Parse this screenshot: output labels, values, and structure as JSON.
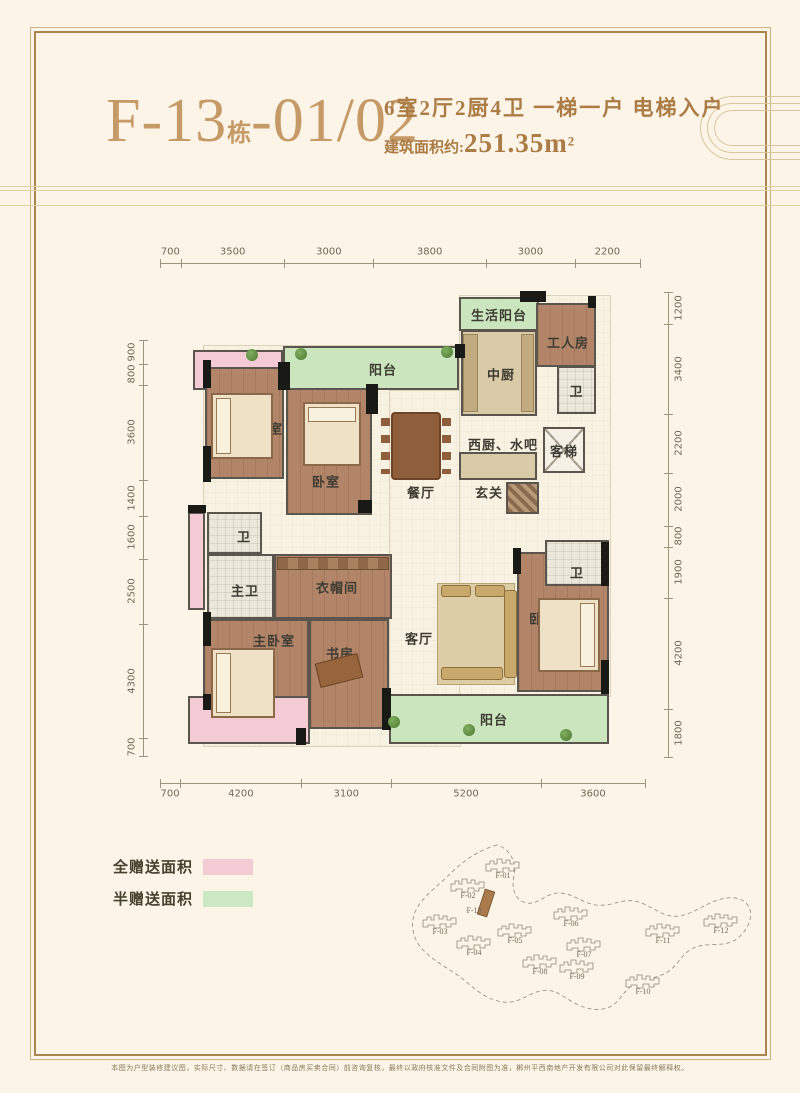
{
  "header": {
    "unit_code_main": "F-13",
    "unit_code_suffix": "栋",
    "unit_code_number": "-01/02",
    "spec_line": "6室2厅2厨4卫 一梯一户 电梯入户",
    "area_label": "建筑面积约:",
    "area_value": "251.35m",
    "area_sup": "2"
  },
  "floorplan": {
    "dimensions": {
      "top": [
        700,
        3500,
        3000,
        3800,
        3000,
        2200
      ],
      "bottom": [
        700,
        4200,
        3100,
        5200,
        3600
      ],
      "left": [
        900,
        800,
        3600,
        1400,
        1600,
        2500,
        4300,
        700
      ],
      "right": [
        1200,
        3400,
        2200,
        2000,
        800,
        1900,
        4200,
        1800
      ]
    },
    "bases": [
      {
        "x": 203,
        "y": 345,
        "w": 256,
        "h": 400
      },
      {
        "x": 389,
        "y": 390,
        "w": 220,
        "h": 305
      },
      {
        "x": 459,
        "y": 295,
        "w": 150,
        "h": 400
      }
    ],
    "rooms": [
      {
        "id": "gift-balcony-top",
        "label": "",
        "x": 193,
        "y": 350,
        "w": 90,
        "h": 40,
        "fill": "pink"
      },
      {
        "id": "balcony-top",
        "label": "阳台",
        "x": 283,
        "y": 346,
        "w": 176,
        "h": 44,
        "fill": "green",
        "lx": 381,
        "ly": 367
      },
      {
        "id": "life-balcony",
        "label": "生活阳台",
        "x": 459,
        "y": 297,
        "w": 80,
        "h": 34,
        "fill": "green"
      },
      {
        "id": "worker-room",
        "label": "工人房",
        "x": 536,
        "y": 303,
        "w": 60,
        "h": 64,
        "fill": "wood",
        "lx": 566,
        "ly": 340
      },
      {
        "id": "kitchen-cn",
        "label": "中厨",
        "x": 461,
        "y": 330,
        "w": 76,
        "h": 86,
        "fill": "counter",
        "lx": 499,
        "ly": 372
      },
      {
        "id": "bath-top",
        "label": "卫",
        "x": 557,
        "y": 366,
        "w": 39,
        "h": 48,
        "fill": "tile"
      },
      {
        "id": "elevator",
        "label": "客梯",
        "x": 543,
        "y": 427,
        "w": 42,
        "h": 46,
        "fill": "elevator"
      },
      {
        "id": "west-kitchen-bar",
        "label": "",
        "x": 459,
        "y": 452,
        "w": 78,
        "h": 28,
        "fill": "counter"
      },
      {
        "id": "foyer-rug",
        "label": "",
        "x": 506,
        "y": 482,
        "w": 33,
        "h": 32,
        "fill": "rug"
      },
      {
        "id": "bedroom-1",
        "label": "卧室",
        "x": 205,
        "y": 367,
        "w": 79,
        "h": 112,
        "fill": "wood",
        "lx": 267,
        "ly": 426
      },
      {
        "id": "bedroom-2",
        "label": "卧室",
        "x": 286,
        "y": 388,
        "w": 86,
        "h": 127,
        "fill": "wood",
        "lx": 324,
        "ly": 479
      },
      {
        "id": "bath-2",
        "label": "卫",
        "x": 207,
        "y": 512,
        "w": 55,
        "h": 42,
        "fill": "tile",
        "lx": 242,
        "ly": 534
      },
      {
        "id": "master-bath",
        "label": "主卫",
        "x": 207,
        "y": 554,
        "w": 67,
        "h": 65,
        "fill": "tile",
        "lx": 243,
        "ly": 588
      },
      {
        "id": "closet",
        "label": "衣帽间",
        "x": 274,
        "y": 554,
        "w": 118,
        "h": 65,
        "fill": "wood",
        "lx": 335,
        "ly": 585
      },
      {
        "id": "master-bedroom",
        "label": "主卧室",
        "x": 203,
        "y": 619,
        "w": 106,
        "h": 110,
        "fill": "wood",
        "lx": 272,
        "ly": 638
      },
      {
        "id": "study",
        "label": "书房",
        "x": 309,
        "y": 619,
        "w": 80,
        "h": 110,
        "fill": "wood",
        "lx": 338,
        "ly": 651
      },
      {
        "id": "bedroom-3",
        "label": "卧室",
        "x": 517,
        "y": 552,
        "w": 92,
        "h": 140,
        "fill": "wood",
        "lx": 541,
        "ly": 616
      },
      {
        "id": "bath-3",
        "label": "卫",
        "x": 545,
        "y": 540,
        "w": 64,
        "h": 46,
        "fill": "tile",
        "lx": 575,
        "ly": 570
      },
      {
        "id": "balcony-bottom",
        "label": "阳台",
        "x": 389,
        "y": 694,
        "w": 220,
        "h": 50,
        "fill": "green",
        "lx": 492,
        "ly": 717
      },
      {
        "id": "gift-strip-left",
        "label": "",
        "x": 188,
        "y": 512,
        "w": 17,
        "h": 98,
        "fill": "pink"
      },
      {
        "id": "gift-balcony-bottom",
        "label": "",
        "x": 188,
        "y": 696,
        "w": 122,
        "h": 48,
        "fill": "pink"
      }
    ],
    "texts": [
      {
        "text": "西厨、水吧",
        "x": 503,
        "y": 444
      },
      {
        "text": "玄关",
        "x": 489,
        "y": 492
      },
      {
        "text": "餐厅",
        "x": 421,
        "y": 492
      },
      {
        "text": "客厅",
        "x": 419,
        "y": 638
      }
    ],
    "wall_chunks": [
      [
        520,
        291,
        26,
        11
      ],
      [
        278,
        362,
        12,
        28
      ],
      [
        366,
        384,
        12,
        30
      ],
      [
        455,
        344,
        10,
        14
      ],
      [
        203,
        360,
        8,
        28
      ],
      [
        203,
        446,
        8,
        36
      ],
      [
        358,
        500,
        14,
        13
      ],
      [
        188,
        505,
        18,
        8
      ],
      [
        203,
        612,
        8,
        34
      ],
      [
        203,
        694,
        8,
        16
      ],
      [
        382,
        688,
        9,
        42
      ],
      [
        601,
        542,
        8,
        44
      ],
      [
        601,
        660,
        8,
        34
      ],
      [
        296,
        728,
        10,
        17
      ],
      [
        588,
        296,
        8,
        12
      ],
      [
        513,
        548,
        8,
        26
      ]
    ],
    "furniture": [
      {
        "t": "bed",
        "side": "l",
        "x": 211,
        "y": 393,
        "w": 62,
        "h": 66
      },
      {
        "t": "bed",
        "side": "t",
        "x": 303,
        "y": 402,
        "w": 58,
        "h": 64
      },
      {
        "t": "bed",
        "side": "l",
        "x": 211,
        "y": 648,
        "w": 64,
        "h": 70
      },
      {
        "t": "bed",
        "side": "r",
        "x": 538,
        "y": 598,
        "w": 62,
        "h": 74
      },
      {
        "t": "table",
        "x": 391,
        "y": 412,
        "w": 50,
        "h": 68
      },
      {
        "t": "chairs",
        "x": 381,
        "y": 418,
        "w": 9,
        "h": 56
      },
      {
        "t": "chairs",
        "x": 442,
        "y": 418,
        "w": 9,
        "h": 56
      },
      {
        "t": "rug2",
        "x": 437,
        "y": 583,
        "w": 78,
        "h": 102
      },
      {
        "t": "sofa",
        "x": 504,
        "y": 590,
        "w": 13,
        "h": 88
      },
      {
        "t": "sofa",
        "x": 441,
        "y": 585,
        "w": 30,
        "h": 12
      },
      {
        "t": "sofa",
        "x": 475,
        "y": 585,
        "w": 30,
        "h": 12
      },
      {
        "t": "sofa",
        "x": 441,
        "y": 667,
        "w": 62,
        "h": 13
      },
      {
        "t": "desk",
        "x": 317,
        "y": 658,
        "w": 44,
        "h": 25
      },
      {
        "t": "strip",
        "x": 277,
        "y": 557,
        "w": 112,
        "h": 13
      },
      {
        "t": "cstrip",
        "x": 463,
        "y": 334,
        "w": 15,
        "h": 78
      },
      {
        "t": "cstrip",
        "x": 521,
        "y": 334,
        "w": 13,
        "h": 78
      }
    ],
    "plants": [
      [
        295,
        348
      ],
      [
        441,
        346
      ],
      [
        246,
        349
      ],
      [
        463,
        724
      ],
      [
        560,
        729
      ],
      [
        388,
        716
      ]
    ]
  },
  "legend": {
    "items": [
      {
        "label": "全赠送面积",
        "color": "#f3cbd5"
      },
      {
        "label": "半赠送面积",
        "color": "#cde8c4"
      }
    ]
  },
  "sitemap": {
    "highlight": "F-13",
    "buildings": [
      {
        "label": "F-01",
        "x": 503,
        "y": 878
      },
      {
        "label": "F-02",
        "x": 468,
        "y": 898
      },
      {
        "label": "F-13",
        "x": 474,
        "y": 913
      },
      {
        "label": "F-03",
        "x": 440,
        "y": 934
      },
      {
        "label": "F-04",
        "x": 474,
        "y": 955
      },
      {
        "label": "F-05",
        "x": 515,
        "y": 943
      },
      {
        "label": "F-06",
        "x": 571,
        "y": 926
      },
      {
        "label": "F-07",
        "x": 584,
        "y": 957
      },
      {
        "label": "F-08",
        "x": 540,
        "y": 974
      },
      {
        "label": "F-09",
        "x": 577,
        "y": 979
      },
      {
        "label": "F-10",
        "x": 643,
        "y": 994
      },
      {
        "label": "F-11",
        "x": 663,
        "y": 943
      },
      {
        "label": "F-12",
        "x": 721,
        "y": 933
      }
    ]
  },
  "footer": {
    "disclaimer": "本图为户型装修建议图，实际尺寸、数据请在签订（商品房买卖合同）前咨询复核，最终以政府核准文件及合同附图为准，郴州平西南地产开发有限公司对此保留最终解释权。"
  }
}
